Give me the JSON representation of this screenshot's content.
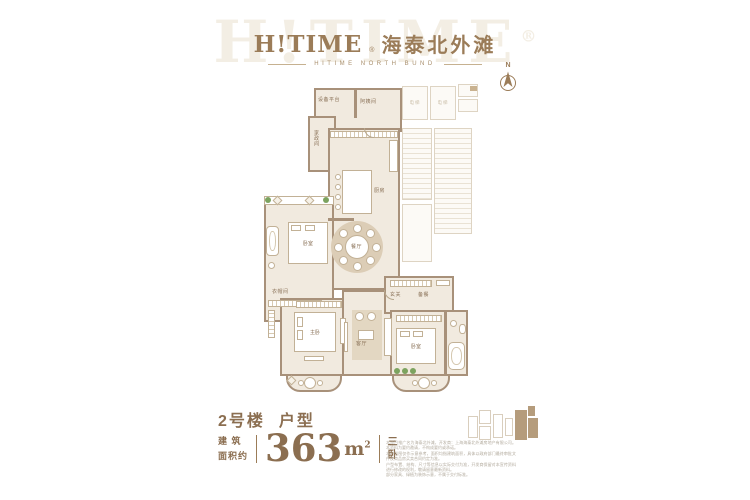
{
  "header": {
    "watermark": "H!TIME",
    "reg": "®",
    "logo_en": "H!TIME",
    "logo_cn": "海泰北外滩",
    "subtitle": "HITIME NORTH BUND"
  },
  "compass": {
    "north": "N"
  },
  "floorplan": {
    "labels": {
      "equipment_platform": "设备平台",
      "nanny_room": "阿姨间",
      "housekeeping": "家政间",
      "kitchen": "厨房",
      "dining": "餐厅",
      "bedroom_left": "卧室",
      "cloakroom": "衣帽间",
      "master_bedroom": "主卧",
      "living_room": "客厅",
      "foyer": "玄关",
      "pantry": "备餐",
      "bedroom_right": "卧室",
      "elevator": "电梯"
    }
  },
  "info": {
    "building_label": "2号楼",
    "unit_label": "户型",
    "area_cap_line1": "建 筑",
    "area_cap_line2": "面积约",
    "area_value": "363",
    "area_unit": "m",
    "area_sup": "2",
    "rooms_char1": "三",
    "rooms_char2": "卧"
  },
  "disclaimer": {
    "lines": [
      "本项目推广名为海泰北外滩，开发商：上海海泰北外滩房地产有限公司。本资料为要约邀请，不构成要约或承诺。",
      "本户型图仅作示意参考，面积均指建筑面积，具体以政府部门最终审批文件及商品房买卖合同约定为准。",
      "户型布置、结构、尺寸等信息以实际交付为准，开发商保留对本宣传资料进行修改的权利，敬请留意最新资料。",
      "部分家具、绿植为装饰示意，不属于交付标准。"
    ]
  },
  "colors": {
    "accent_brown": "#9b7c58",
    "wall_tan": "#a8917a",
    "floor_cream": "#f1eadf",
    "plant_green": "#7ca35f",
    "keyplan_highlight": "#b59c7c"
  }
}
